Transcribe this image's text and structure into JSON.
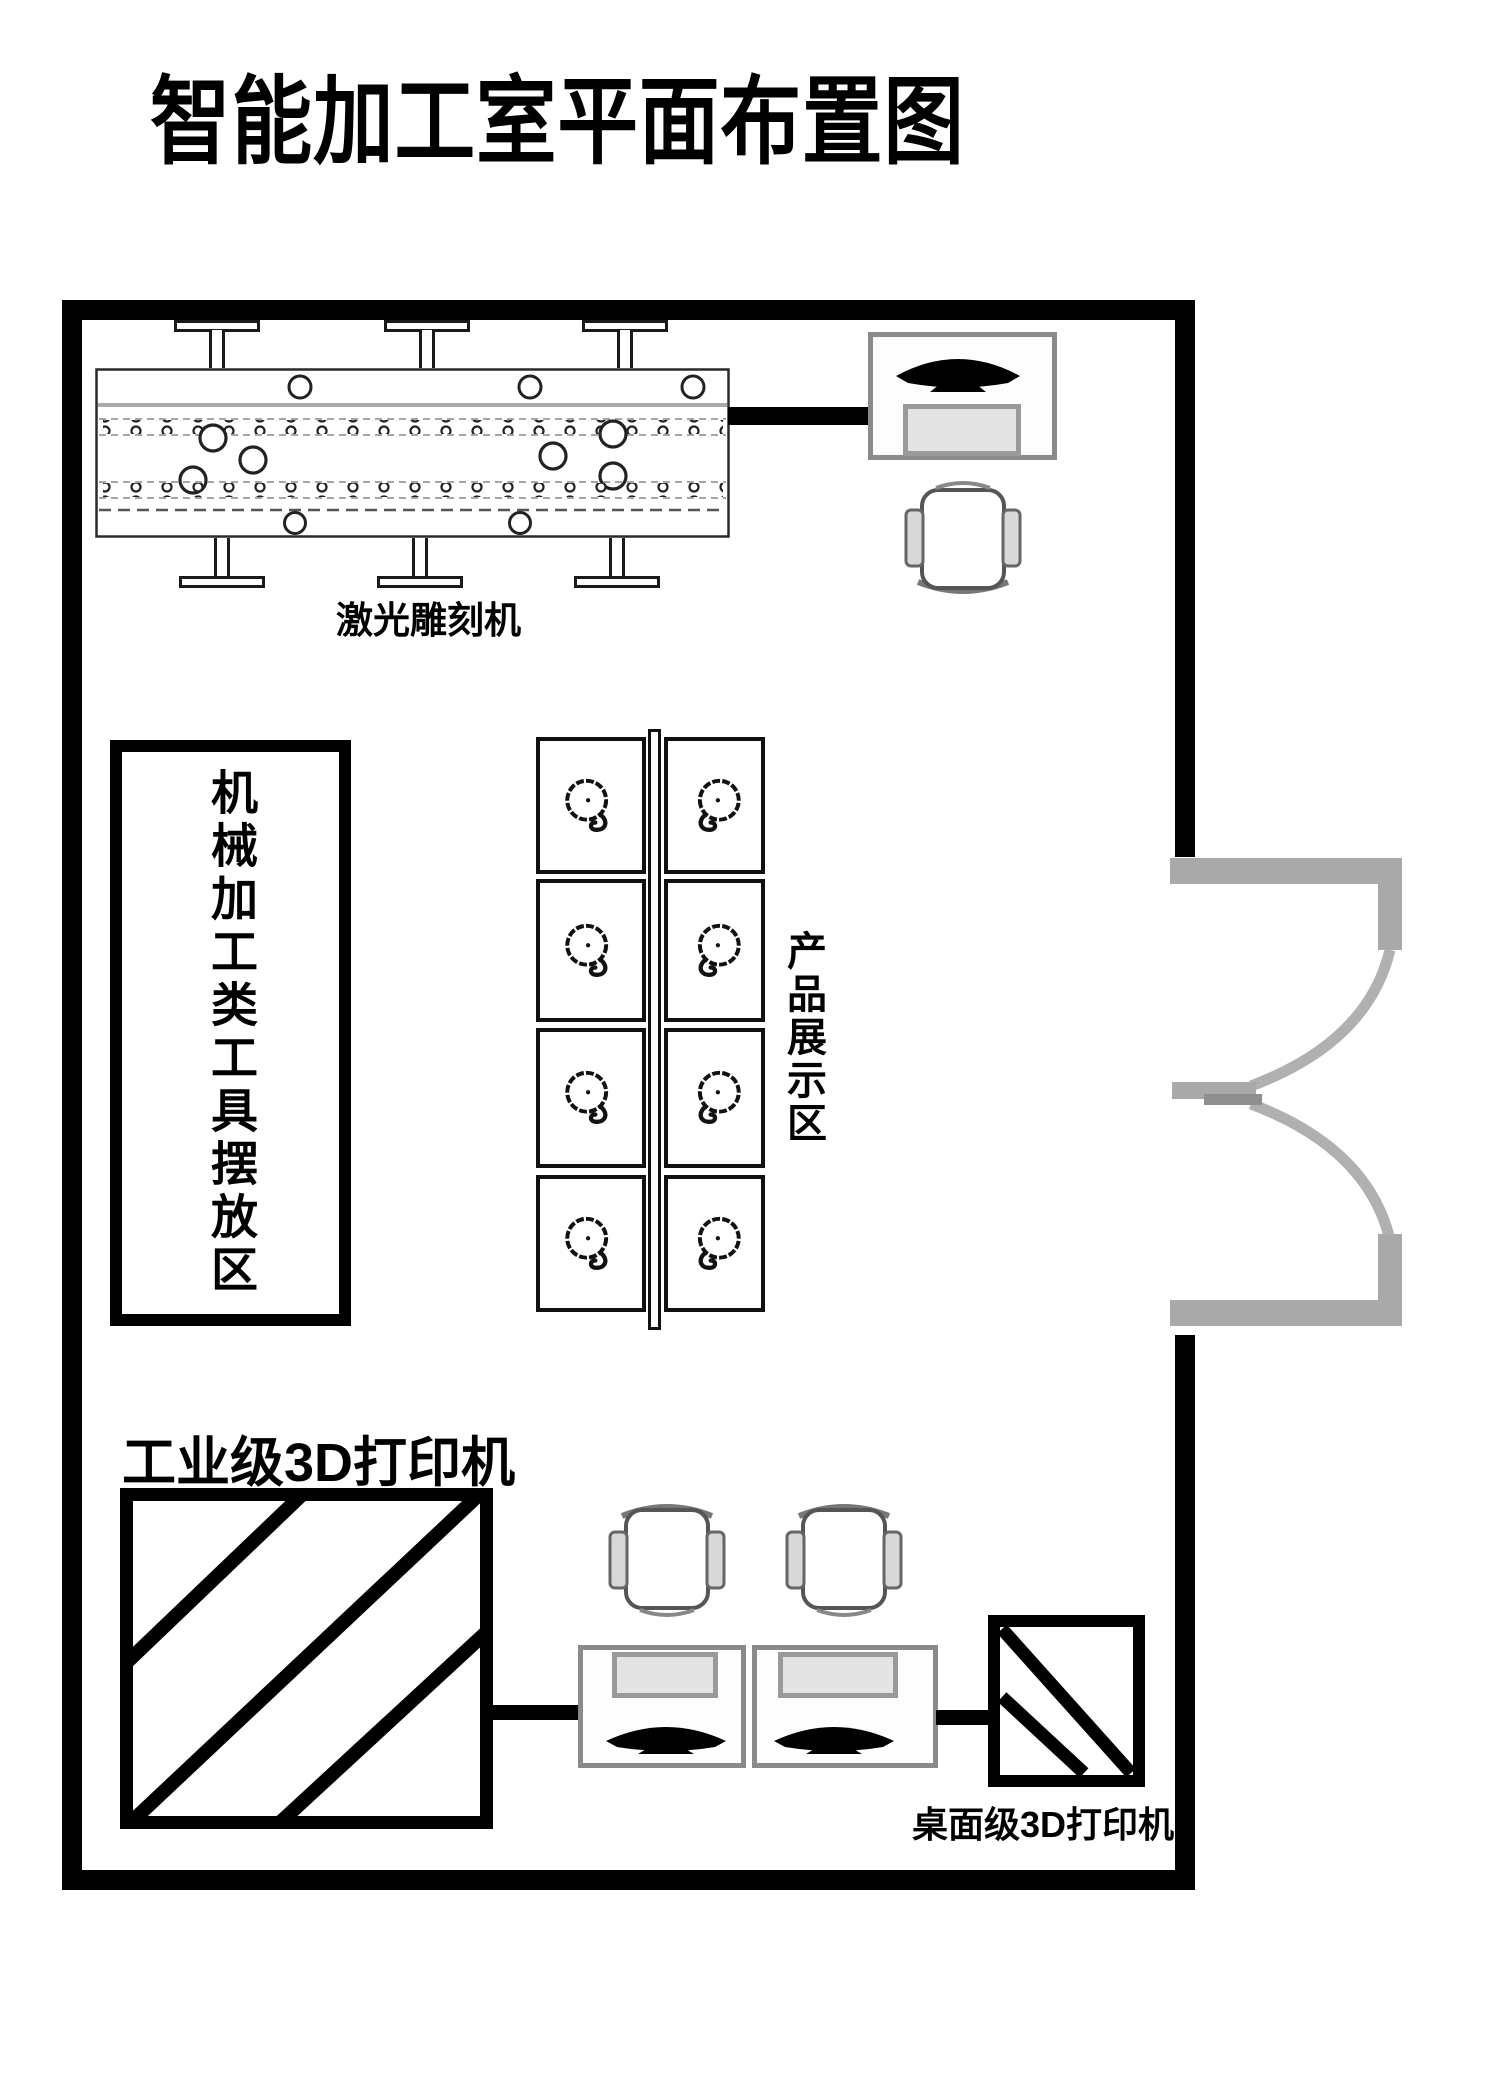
{
  "title": "智能加工室平面布置图",
  "labels": {
    "laser_engraver": "激光雕刻机",
    "tools_area": "机械加工类工具摆放区",
    "display_area": "产品展示区",
    "industrial_printer": "工业级3D打印机",
    "desktop_printer": "桌面级3D打印机"
  },
  "colors": {
    "wall": "#000000",
    "door_symbol": "#a9a9a9",
    "furniture_outline": "#8a8a8a",
    "machine_line": "#222222"
  },
  "icons": {
    "laser_engraver": "laser-engraver-machine-icon",
    "monitor": "monitor-icon",
    "keyboard": "keyboard-icon",
    "chair": "office-chair-icon",
    "rotating_product": "rotating-product-icon",
    "door": "double-swing-door-icon",
    "industrial_printer": "diagonal-striped-box-icon",
    "desktop_printer": "diagonal-striped-box-icon"
  }
}
